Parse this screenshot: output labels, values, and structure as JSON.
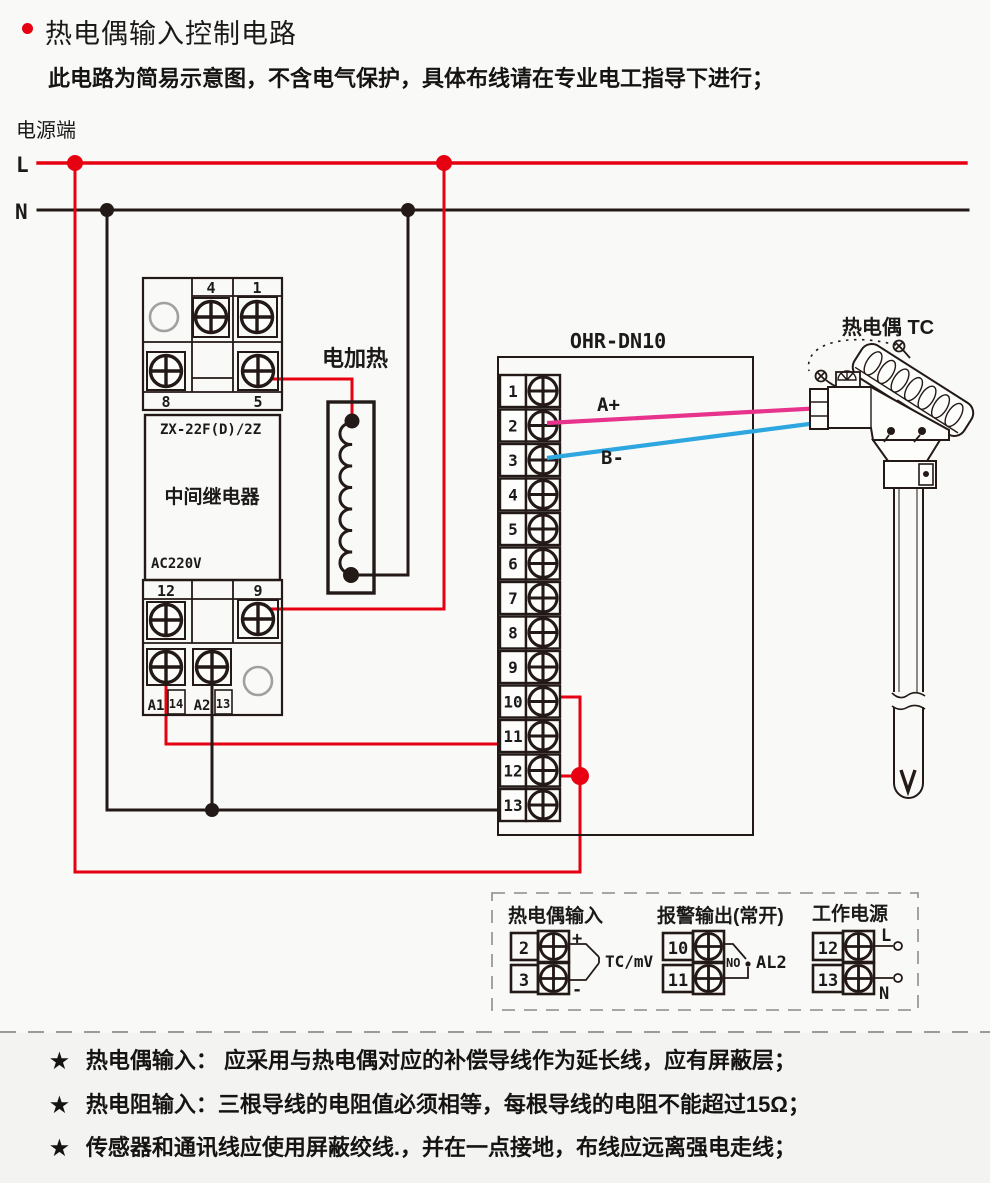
{
  "header": {
    "title": "热电偶输入控制电路",
    "subtitle": "此电路为简易示意图，不含电气保护，具体布线请在专业电工指导下进行；"
  },
  "power": {
    "label": "电源端",
    "live": "L",
    "neutral": "N"
  },
  "relay": {
    "model": "ZX-22F(D)/2Z",
    "name": "中间继电器",
    "voltage": "AC220V",
    "terminals": {
      "t4": "4",
      "t1": "1",
      "t8": "8",
      "t5": "5",
      "t12": "12",
      "t9": "9",
      "a1": "A1",
      "t14": "14",
      "a2": "A2",
      "t13": "13"
    }
  },
  "heater": {
    "label": "电加热"
  },
  "ohr": {
    "title": "OHR-DN10",
    "terminals": [
      "1",
      "2",
      "3",
      "4",
      "5",
      "6",
      "7",
      "8",
      "9",
      "10",
      "11",
      "12",
      "13"
    ],
    "wire_a": "A+",
    "wire_b": "B-"
  },
  "tc": {
    "title": "热电偶 TC"
  },
  "legend": {
    "tc_input": {
      "title": "热电偶输入",
      "t_top": "2",
      "t_bottom": "3",
      "plus": "+",
      "minus": "-",
      "signal": "TC/mV"
    },
    "alarm": {
      "title": "报警输出(常开)",
      "t_top": "10",
      "t_bottom": "11",
      "contact": "NO",
      "name": "AL2"
    },
    "supply": {
      "title": "工作电源",
      "t_top": "12",
      "t_bottom": "13",
      "live": "L",
      "neutral": "N"
    }
  },
  "notes": {
    "bullet": "★",
    "items": [
      "热电偶输入： 应采用与热电偶对应的补偿导线作为延长线，应有屏蔽层；",
      "热电阻输入：三根导线的电阻值必须相等，每根导线的电阻不能超过15Ω；",
      "传感器和通讯线应使用屏蔽绞线.，并在一点接地，布线应远离强电走线；"
    ]
  },
  "colors": {
    "line_red": "#e60012",
    "wire_pink": "#e7338c",
    "wire_blue": "#2ea7e0",
    "ink": "#231916"
  }
}
